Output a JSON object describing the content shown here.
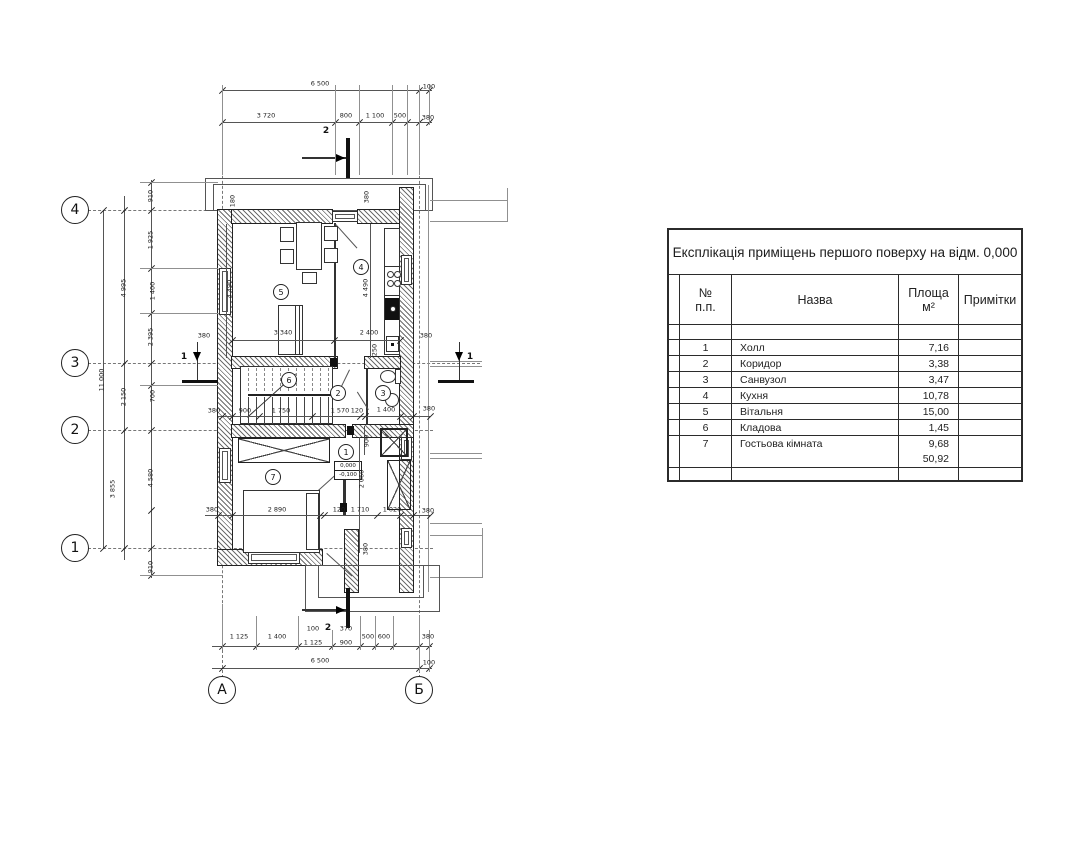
{
  "table": {
    "title": "Експлікація приміщень першого поверху на відм. 0,000",
    "header": {
      "num": "№\nп.п.",
      "name": "Назва",
      "area": "Площа\nм²",
      "notes": "Примітки"
    },
    "rows": [
      {
        "num": "1",
        "name": "Холл",
        "area": "7,16"
      },
      {
        "num": "2",
        "name": "Коридор",
        "area": "3,38"
      },
      {
        "num": "3",
        "name": "Санвузол",
        "area": "3,47"
      },
      {
        "num": "4",
        "name": "Кухня",
        "area": "10,78"
      },
      {
        "num": "5",
        "name": "Вітальня",
        "area": "15,00"
      },
      {
        "num": "6",
        "name": "Кладова",
        "area": "1,45"
      },
      {
        "num": "7",
        "name": "Гостьова кімната",
        "area": "9,68"
      }
    ],
    "total_area": "50,92"
  },
  "plan": {
    "grid_rows": [
      {
        "label": "4",
        "y": 210
      },
      {
        "label": "3",
        "y": 363
      },
      {
        "label": "2",
        "y": 430
      },
      {
        "label": "1",
        "y": 548
      }
    ],
    "grid_cols": [
      {
        "label": "А",
        "x": 222
      },
      {
        "label": "Б",
        "x": 419
      }
    ],
    "room_labels": [
      {
        "n": "1",
        "x": 346,
        "y": 452
      },
      {
        "n": "2",
        "x": 338,
        "y": 393
      },
      {
        "n": "3",
        "x": 383,
        "y": 393
      },
      {
        "n": "4",
        "x": 361,
        "y": 267
      },
      {
        "n": "5",
        "x": 281,
        "y": 292
      },
      {
        "n": "6",
        "x": 289,
        "y": 380
      },
      {
        "n": "7",
        "x": 273,
        "y": 477
      }
    ],
    "section_marks": [
      {
        "label": "2",
        "x": 326,
        "y": 131
      },
      {
        "label": "2",
        "x": 328,
        "y": 628
      },
      {
        "label": "1",
        "x": 184,
        "y": 357
      },
      {
        "label": "1",
        "x": 470,
        "y": 357
      }
    ],
    "elevation_mark": {
      "upper": "0,000",
      "lower": "-0,100"
    },
    "dim_labels": [
      {
        "t": "6 500",
        "x": 320,
        "y": 84
      },
      {
        "t": "100",
        "x": 429,
        "y": 87
      },
      {
        "t": "3 720",
        "x": 266,
        "y": 116
      },
      {
        "t": "800",
        "x": 346,
        "y": 116
      },
      {
        "t": "1 100",
        "x": 375,
        "y": 116
      },
      {
        "t": "500",
        "x": 400,
        "y": 116
      },
      {
        "t": "380",
        "x": 428,
        "y": 118
      },
      {
        "t": "1 125",
        "x": 239,
        "y": 637
      },
      {
        "t": "1 400",
        "x": 277,
        "y": 637
      },
      {
        "t": "100",
        "x": 313,
        "y": 629
      },
      {
        "t": "1 125",
        "x": 313,
        "y": 643
      },
      {
        "t": "370",
        "x": 346,
        "y": 629
      },
      {
        "t": "900",
        "x": 346,
        "y": 643
      },
      {
        "t": "500",
        "x": 368,
        "y": 637
      },
      {
        "t": "600",
        "x": 384,
        "y": 637
      },
      {
        "t": "380",
        "x": 428,
        "y": 637
      },
      {
        "t": "6 500",
        "x": 320,
        "y": 661
      },
      {
        "t": "100",
        "x": 429,
        "y": 663
      },
      {
        "t": "11 000",
        "x": 102,
        "y": 380,
        "rot": true
      },
      {
        "t": "4 995",
        "x": 124,
        "y": 288,
        "rot": true
      },
      {
        "t": "2 150",
        "x": 124,
        "y": 397,
        "rot": true
      },
      {
        "t": "3 855",
        "x": 113,
        "y": 489,
        "rot": true
      },
      {
        "t": "910",
        "x": 151,
        "y": 196,
        "rot": true
      },
      {
        "t": "1 925",
        "x": 151,
        "y": 240,
        "rot": true
      },
      {
        "t": "1 400",
        "x": 153,
        "y": 291,
        "rot": true
      },
      {
        "t": "2 395",
        "x": 151,
        "y": 337,
        "rot": true
      },
      {
        "t": "700",
        "x": 153,
        "y": 396,
        "rot": true
      },
      {
        "t": "4 580",
        "x": 151,
        "y": 478,
        "rot": true
      },
      {
        "t": "910",
        "x": 151,
        "y": 567,
        "rot": true
      },
      {
        "t": "180",
        "x": 233,
        "y": 201,
        "rot": true
      },
      {
        "t": "380",
        "x": 367,
        "y": 197,
        "rot": true
      },
      {
        "t": "4 490",
        "x": 230,
        "y": 289,
        "rot": true
      },
      {
        "t": "4 490",
        "x": 366,
        "y": 288,
        "rot": true
      },
      {
        "t": "3 340",
        "x": 283,
        "y": 333
      },
      {
        "t": "2 400",
        "x": 369,
        "y": 333
      },
      {
        "t": "250",
        "x": 375,
        "y": 350,
        "rot": true
      },
      {
        "t": "380",
        "x": 204,
        "y": 336
      },
      {
        "t": "380",
        "x": 426,
        "y": 336
      },
      {
        "t": "380",
        "x": 214,
        "y": 411
      },
      {
        "t": "900",
        "x": 245,
        "y": 411
      },
      {
        "t": "1 750",
        "x": 281,
        "y": 411
      },
      {
        "t": "1 570",
        "x": 340,
        "y": 411
      },
      {
        "t": "120",
        "x": 357,
        "y": 411
      },
      {
        "t": "1 400",
        "x": 386,
        "y": 410
      },
      {
        "t": "380",
        "x": 429,
        "y": 409
      },
      {
        "t": "900",
        "x": 367,
        "y": 441,
        "rot": true
      },
      {
        "t": "2 060",
        "x": 362,
        "y": 479,
        "rot": true
      },
      {
        "t": "380",
        "x": 212,
        "y": 510
      },
      {
        "t": "2 890",
        "x": 277,
        "y": 510
      },
      {
        "t": "120",
        "x": 339,
        "y": 510
      },
      {
        "t": "1 710",
        "x": 360,
        "y": 510
      },
      {
        "t": "1 020",
        "x": 392,
        "y": 510
      },
      {
        "t": "380",
        "x": 428,
        "y": 511
      },
      {
        "t": "380",
        "x": 366,
        "y": 549,
        "rot": true
      }
    ]
  }
}
